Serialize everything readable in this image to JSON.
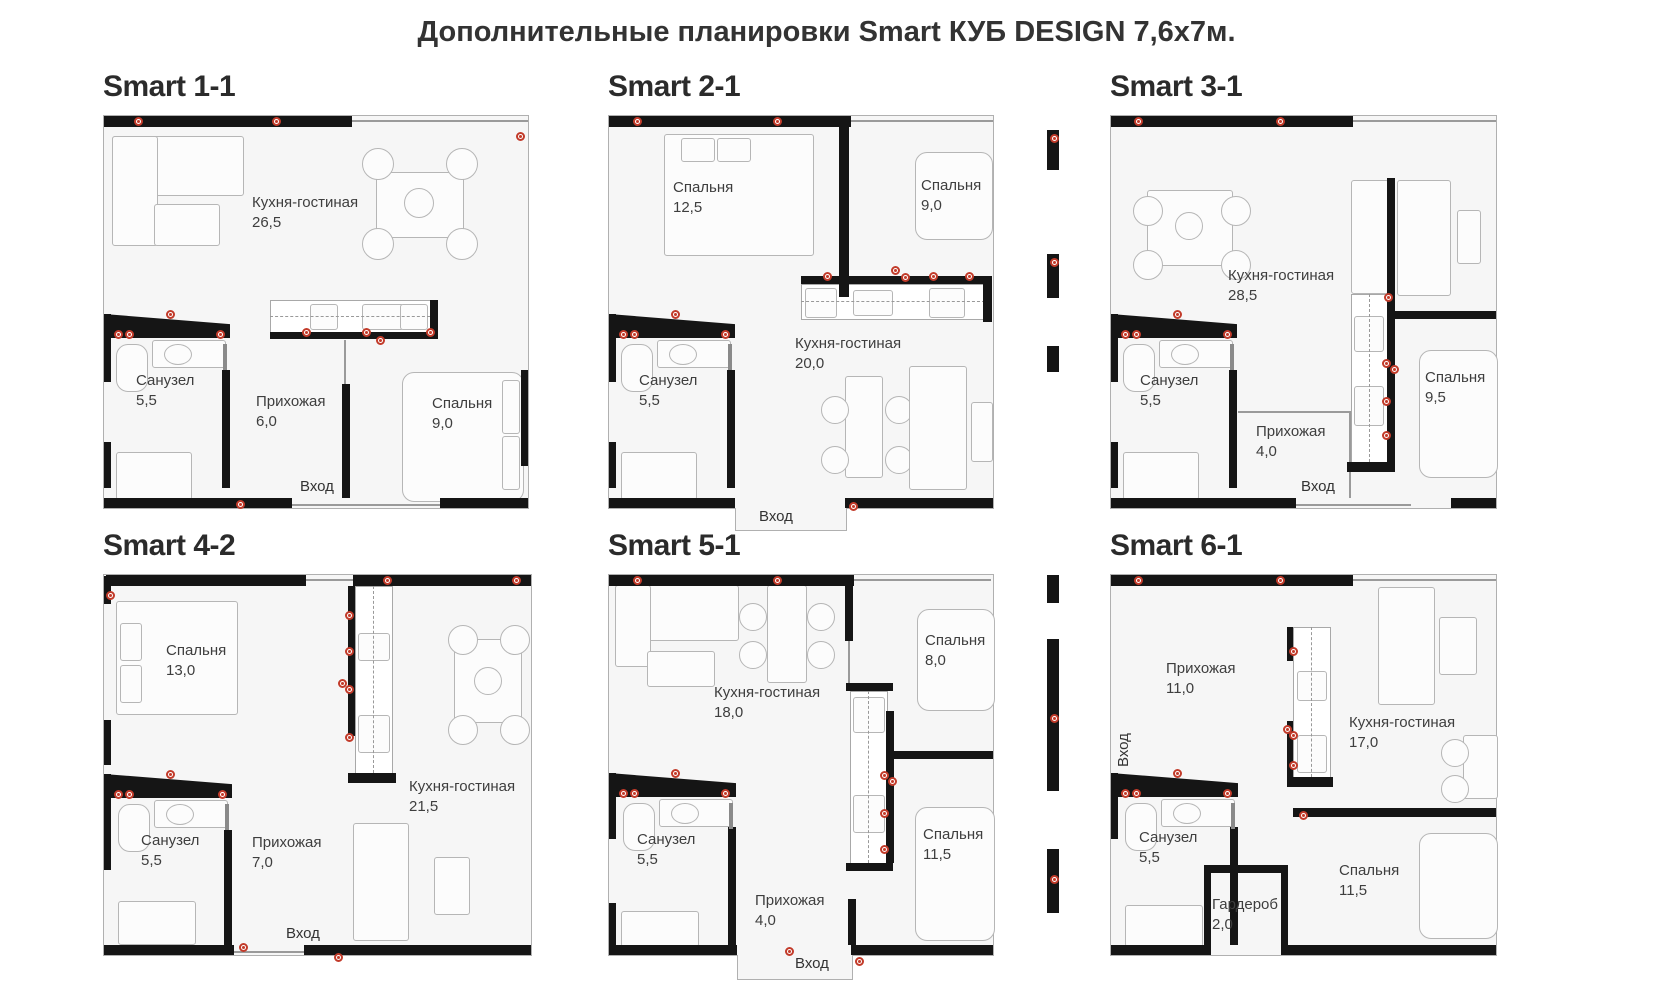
{
  "title": "Дополнительные планировки Smart КУБ DESIGN 7,6х7м.",
  "colors": {
    "wall": "#151515",
    "outlet_marker": "#c23b2a",
    "label_text": "#3e3e3e"
  },
  "plans": [
    {
      "name": "Smart 1-1",
      "entrance": "Вход",
      "rooms": [
        {
          "label": "Кухня-гостиная",
          "area": "26,5"
        },
        {
          "label": "Санузел",
          "area": "5,5"
        },
        {
          "label": "Прихожая",
          "area": "6,0"
        },
        {
          "label": "Спальня",
          "area": "9,0"
        }
      ]
    },
    {
      "name": "Smart 2-1",
      "entrance": "Вход",
      "rooms": [
        {
          "label": "Спальня",
          "area": "12,5"
        },
        {
          "label": "Спальня",
          "area": "9,0"
        },
        {
          "label": "Кухня-гостиная",
          "area": "20,0"
        },
        {
          "label": "Санузел",
          "area": "5,5"
        }
      ]
    },
    {
      "name": "Smart 3-1",
      "entrance": "Вход",
      "rooms": [
        {
          "label": "Кухня-гостиная",
          "area": "28,5"
        },
        {
          "label": "Санузел",
          "area": "5,5"
        },
        {
          "label": "Прихожая",
          "area": "4,0"
        },
        {
          "label": "Спальня",
          "area": "9,5"
        }
      ]
    },
    {
      "name": "Smart 4-2",
      "entrance": "Вход",
      "rooms": [
        {
          "label": "Спальня",
          "area": "13,0"
        },
        {
          "label": "Кухня-гостиная",
          "area": "21,5"
        },
        {
          "label": "Санузел",
          "area": "5,5"
        },
        {
          "label": "Прихожая",
          "area": "7,0"
        }
      ]
    },
    {
      "name": "Smart 5-1",
      "entrance": "Вход",
      "rooms": [
        {
          "label": "Кухня-гостиная",
          "area": "18,0"
        },
        {
          "label": "Спальня",
          "area": "8,0"
        },
        {
          "label": "Санузел",
          "area": "5,5"
        },
        {
          "label": "Спальня",
          "area": "11,5"
        },
        {
          "label": "Прихожая",
          "area": "4,0"
        }
      ]
    },
    {
      "name": "Smart 6-1",
      "entrance": "Вход",
      "rooms": [
        {
          "label": "Прихожая",
          "area": "11,0"
        },
        {
          "label": "Кухня-гостиная",
          "area": "17,0"
        },
        {
          "label": "Санузел",
          "area": "5,5"
        },
        {
          "label": "Гардероб",
          "area": "2,0"
        },
        {
          "label": "Спальня",
          "area": "11,5"
        }
      ]
    }
  ]
}
